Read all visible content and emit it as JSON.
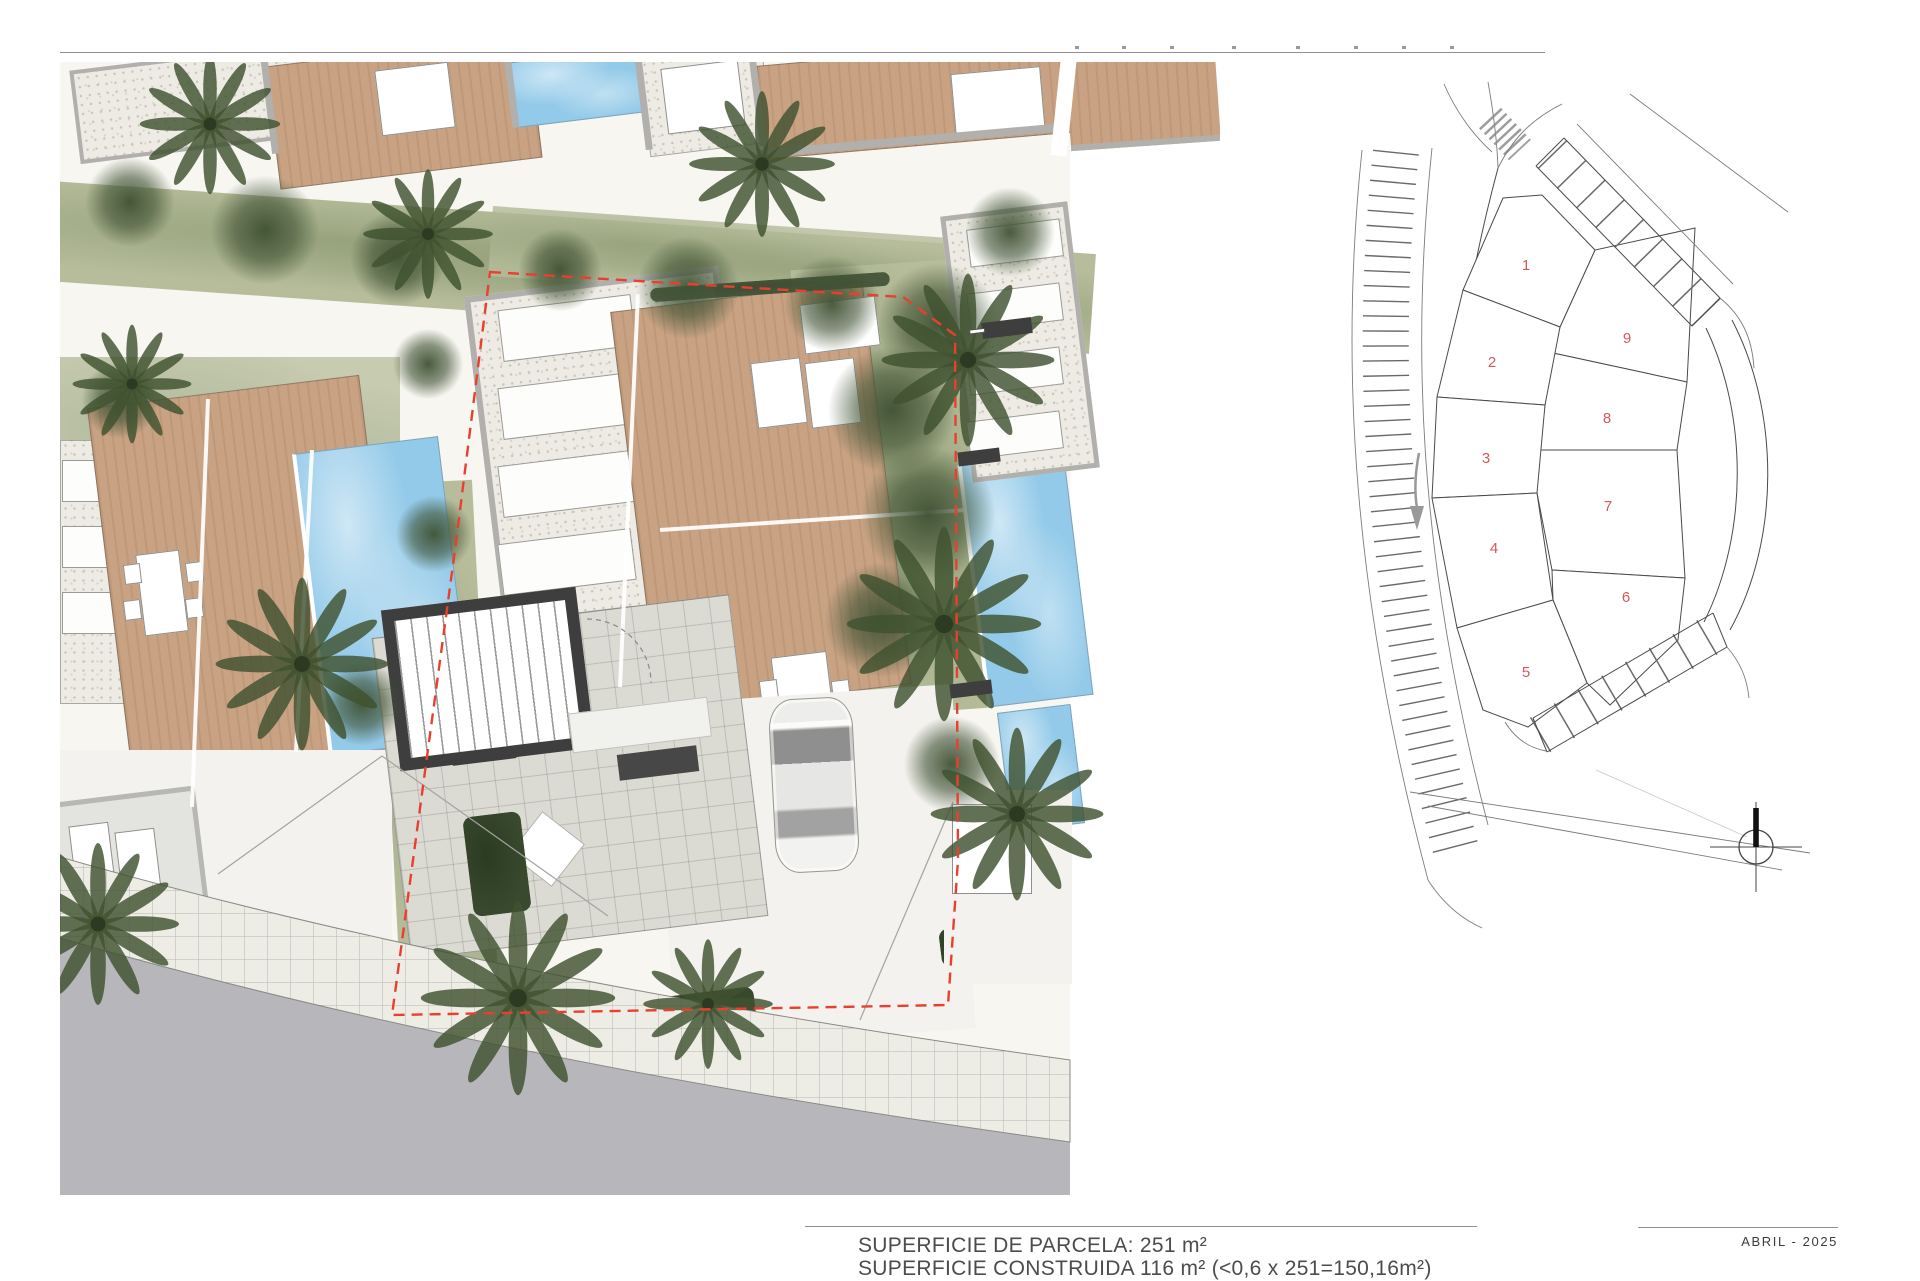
{
  "palette": {
    "text": "#4c4c4c",
    "date_text": "#3c3c3c",
    "rule": "#8f8f8f",
    "wood": "#c8a283",
    "gravel": "#edebe4",
    "pool": "#93cae9",
    "grass": "#b7bd9b",
    "tree": "#46583a",
    "palm": "#3f5230",
    "road": "#b7b7bb",
    "sidewalk": "#edece5",
    "court": "#f3f2ee",
    "boundary_red": "#e8402f",
    "dark_wall": "#3e3e3e",
    "parapet": "#b1b0ad",
    "keyplan_line": "#4a4a4a",
    "keyplan_road": "#6a6a6a",
    "keyplan_highlight": "#f7d3d6",
    "keyplan_number": "#d4595a"
  },
  "titleblock": {
    "parcel_area": "SUPERFICIE DE PARCELA: 251 m²",
    "built_area": "SUPERFICIE CONSTRUIDA 116 m² (<0,6 x 251=150,16m²)",
    "date": "ABRIL - 2025"
  },
  "keyplan": {
    "highlight_color": "#f7d3d6",
    "parcels": [
      {
        "label": "1",
        "highlighted": true
      },
      {
        "label": "2",
        "highlighted": true
      },
      {
        "label": "3",
        "highlighted": true
      },
      {
        "label": "4",
        "highlighted": false
      },
      {
        "label": "5",
        "highlighted": false
      },
      {
        "label": "6",
        "highlighted": false
      },
      {
        "label": "7",
        "highlighted": false
      },
      {
        "label": "8",
        "highlighted": false
      },
      {
        "label": "9",
        "highlighted": false
      }
    ]
  }
}
